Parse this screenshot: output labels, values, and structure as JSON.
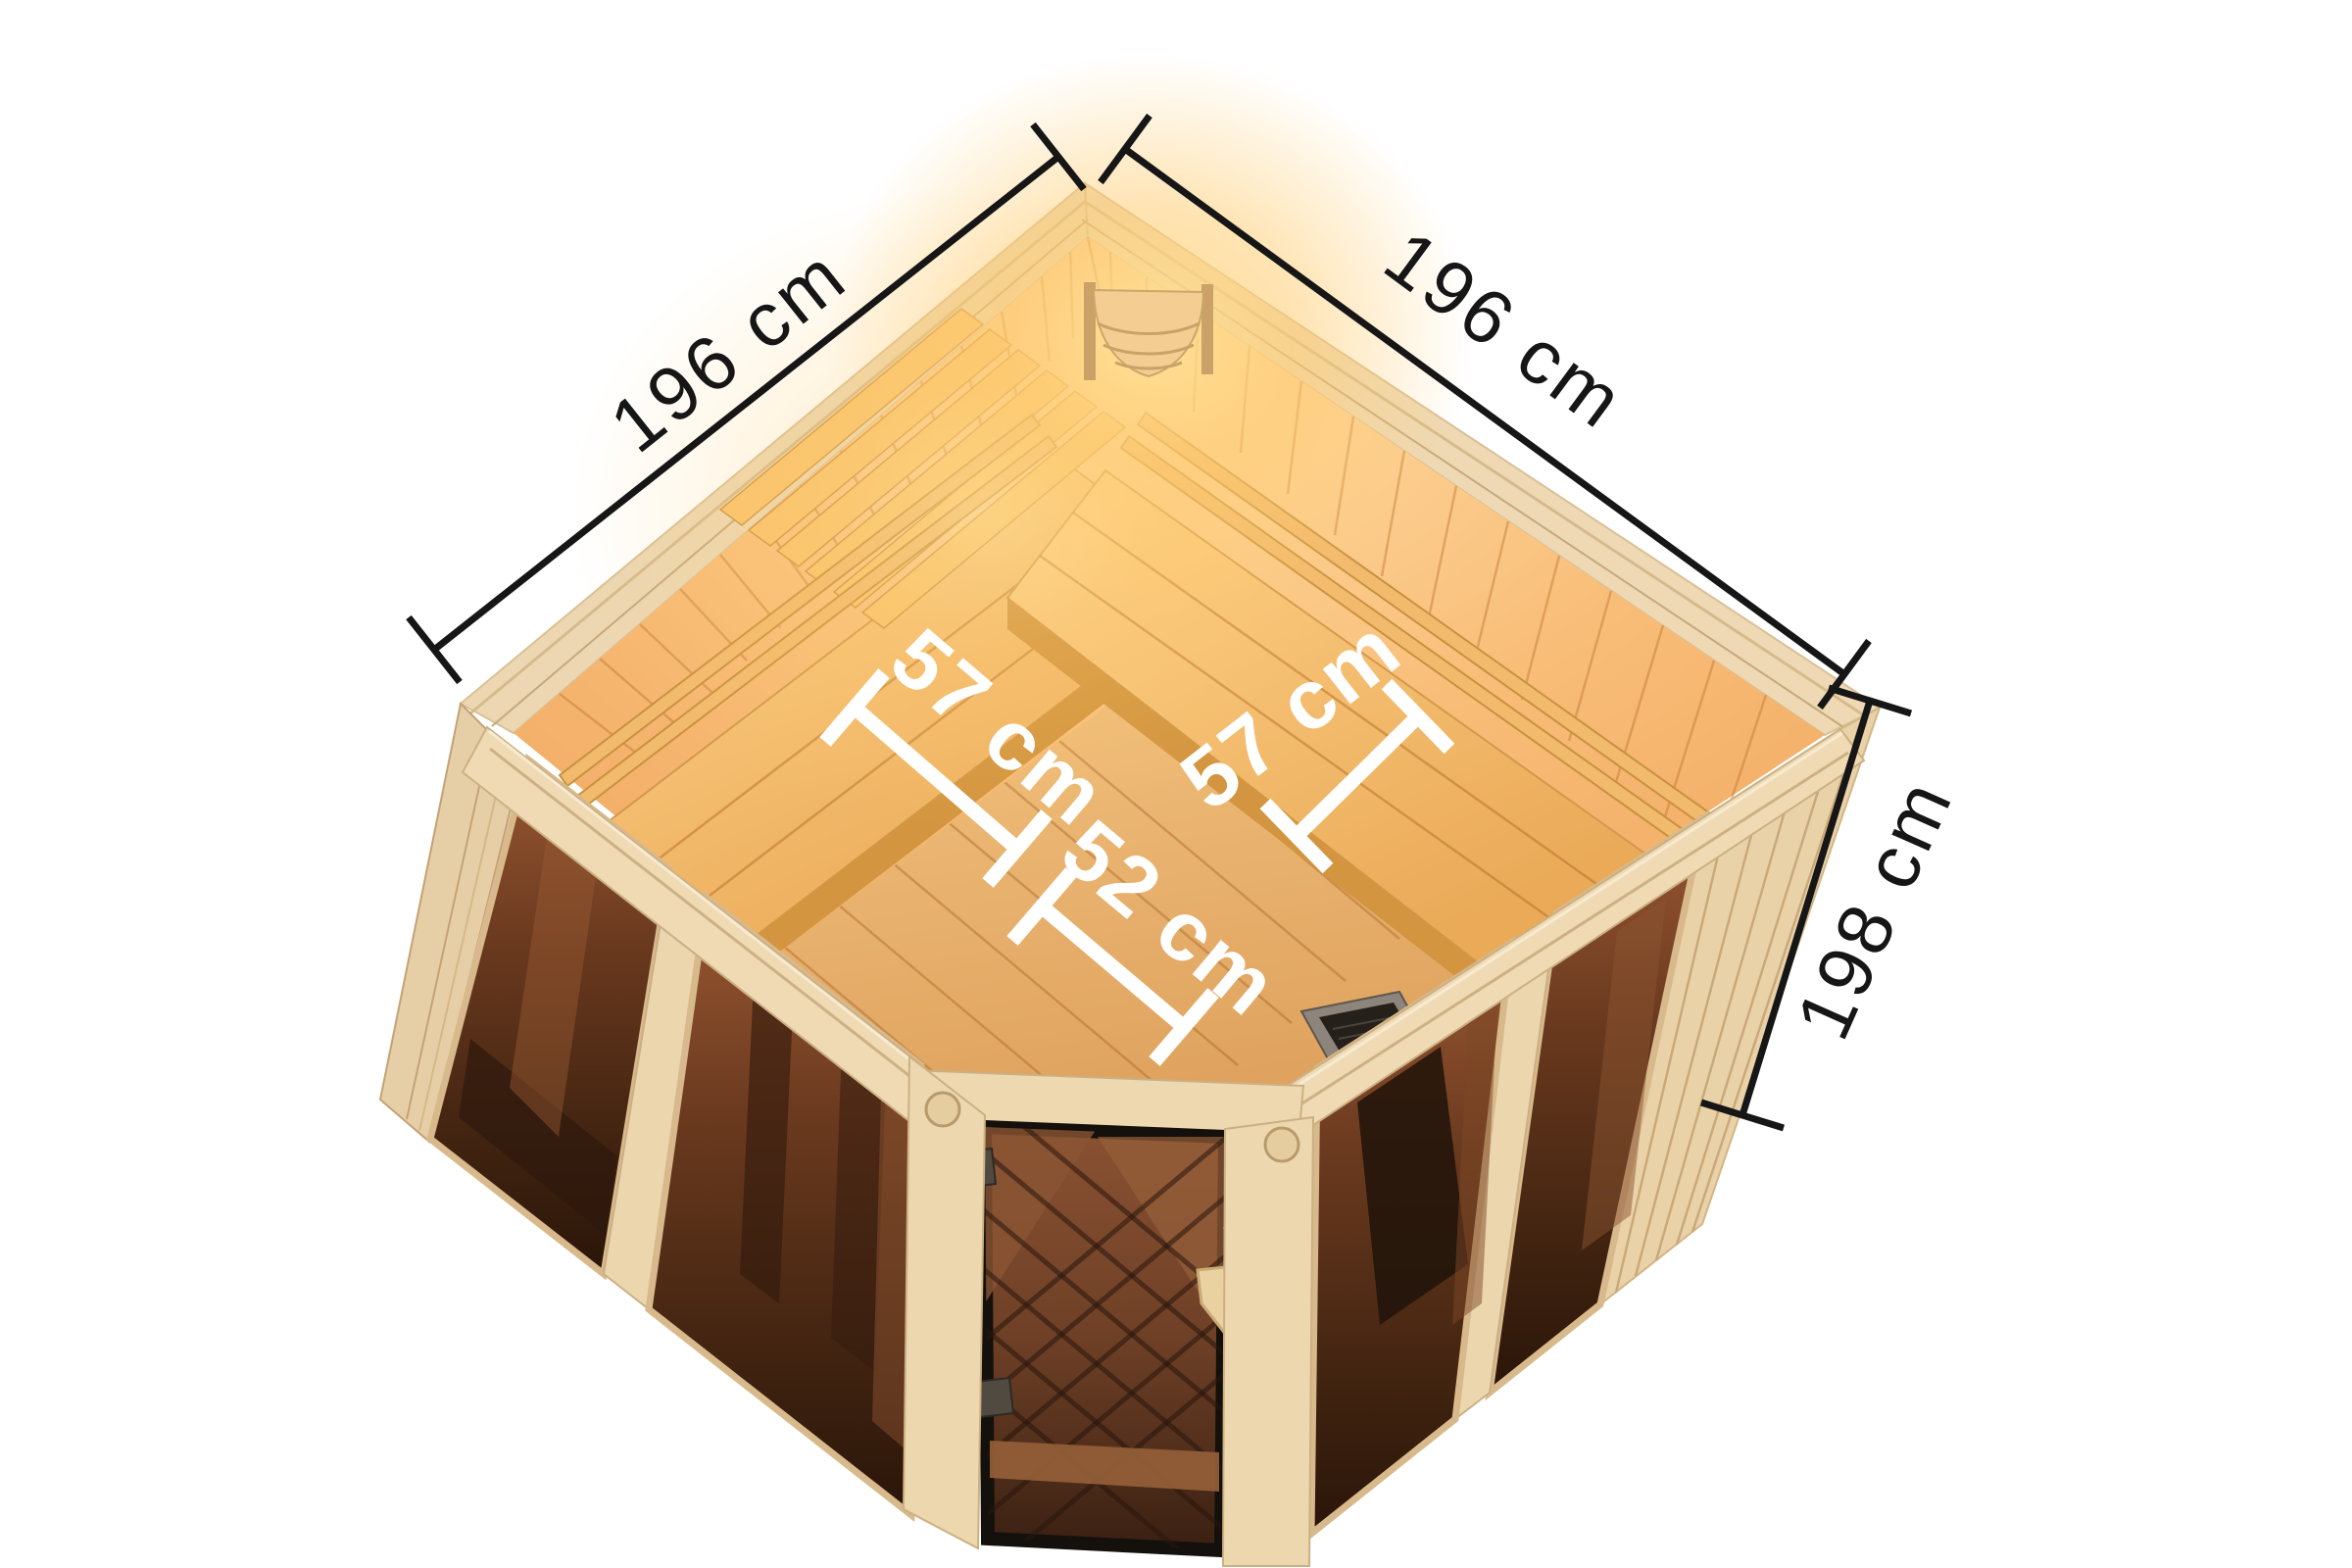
{
  "image": {
    "title": "Corner sauna – top view dimension diagram",
    "background": "#ffffff"
  },
  "annotations": {
    "wall_left": {
      "label": "196 cm"
    },
    "wall_right": {
      "label": "196 cm"
    },
    "side_height": {
      "label": "198 cm"
    },
    "bench_left_depth": {
      "label": "57 cm"
    },
    "bench_right_depth": {
      "label": "57 cm"
    },
    "front_clearance": {
      "label": "52 cm"
    }
  },
  "colors": {
    "dimension_line_black": "#161616",
    "dimension_line_white": "#ffffff",
    "wood_frame_light": "#eed9b4",
    "wood_wall_warm": "#f5b36a",
    "wood_bench_gold": "#f2b868",
    "wood_floor": "#e8b873",
    "glass_bronze_dark": "#3a2012",
    "glass_bronze_light": "#9a5833",
    "glow_warm": "#ffdf9e",
    "heater_dark": "#26201a"
  }
}
